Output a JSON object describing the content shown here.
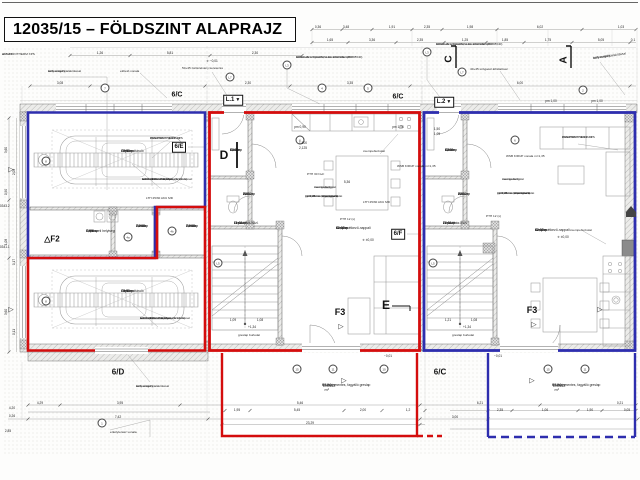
{
  "sheet": {
    "title": "12035/15 – FÖLDSZINT ALAPRAJZ"
  },
  "colors": {
    "unit_red": "#d40d0d",
    "unit_blue": "#2e2eae",
    "wall_hatch": "#b0b0b0",
    "dim_text": "#222222"
  },
  "rooms": [
    {
      "id": "G2.01",
      "name": "Gépkocsitároló",
      "area": "19,50 m²",
      "floor": "Greslap",
      "x": 121,
      "y": 149
    },
    {
      "id": "G1.01",
      "name": "Gépkocsitároló",
      "area": "19,50 m²",
      "floor": "Greslap",
      "x": 121,
      "y": 289
    },
    {
      "id": "G.03",
      "name": "Gépészeti helyiség",
      "area": "5,59 m²",
      "floor": "Greslap",
      "x": 86,
      "y": 229
    },
    {
      "id": "G2.02",
      "name": "Tároló",
      "area": "2,70 m²",
      "floor": "Greslap",
      "x": 136,
      "y": 224
    },
    {
      "id": "G1.02",
      "name": "Tároló",
      "area": "2,70 m²",
      "floor": "Greslap",
      "x": 186,
      "y": 224
    },
    {
      "id": "L1.01",
      "name": "Előtér",
      "area": "4,14 m²",
      "floor": "Greslap",
      "x": 230,
      "y": 148
    },
    {
      "id": "L1.02",
      "name": "WC",
      "area": "2,04 m²",
      "floor": "Greslap",
      "x": 243,
      "y": 192
    },
    {
      "id": "L1.04",
      "name": "Lépcsőház-közl.",
      "area": "11,02 m²",
      "floor": "Greslap",
      "x": 234,
      "y": 221
    },
    {
      "id": "L1.03",
      "name": "Konyha-étkező-nappali",
      "area": "42,00 m²",
      "floor": "Greslap",
      "x": 336,
      "y": 226
    },
    {
      "id": "L2.01",
      "name": "Előtér",
      "area": "4,14 m²",
      "floor": "Greslap",
      "x": 445,
      "y": 148
    },
    {
      "id": "L2.02",
      "name": "WC",
      "area": "2,04 m²",
      "floor": "Greslap",
      "x": 458,
      "y": 192
    },
    {
      "id": "L2.04",
      "name": "Lépcsőház-közl.",
      "area": "24,81 m²",
      "floor": "Greslap",
      "x": 443,
      "y": 221
    },
    {
      "id": "L2.03",
      "name": "Konyha-étkező-nappali",
      "area": "42,00 m²",
      "floor": "Greslap",
      "x": 535,
      "y": 228
    }
  ],
  "terraces": [
    {
      "name": "Terasz",
      "area": "17,50 m²",
      "note": "Csúszásmentes, fagyálló greslap",
      "x": 322,
      "y": 383
    },
    {
      "name": "Terasz",
      "area": "17,50 m²",
      "note": "Csúszásmentes, fagyálló greslap",
      "x": 552,
      "y": 383
    }
  ],
  "markers": {
    "boxed": [
      {
        "t": "L.1",
        "x": 233,
        "y": 100,
        "tri": true
      },
      {
        "t": "L.2",
        "x": 444,
        "y": 102,
        "tri": true
      },
      {
        "t": "6/E",
        "x": 179,
        "y": 147
      },
      {
        "t": "6/F",
        "x": 398,
        "y": 234
      }
    ],
    "plain": [
      {
        "t": "6/C",
        "x": 177,
        "y": 95,
        "s": 7
      },
      {
        "t": "6/C",
        "x": 398,
        "y": 97,
        "s": 7
      },
      {
        "t": "6/D",
        "x": 118,
        "y": 372,
        "s": 8
      },
      {
        "t": "6/C",
        "x": 440,
        "y": 372,
        "s": 8
      },
      {
        "t": "D",
        "x": 224,
        "y": 155,
        "s": 12
      },
      {
        "t": "E",
        "x": 386,
        "y": 305,
        "s": 12
      },
      {
        "t": "F3",
        "x": 340,
        "y": 312,
        "s": 9
      },
      {
        "t": "F3",
        "x": 532,
        "y": 310,
        "s": 9
      },
      {
        "t": "△F2",
        "x": 52,
        "y": 239,
        "s": 8
      }
    ],
    "rotated": [
      {
        "t": "C",
        "x": 449,
        "y": 59
      },
      {
        "t": "A",
        "x": 564,
        "y": 60
      }
    ],
    "triangles": [
      {
        "x": 341,
        "y": 327
      },
      {
        "x": 534,
        "y": 325
      },
      {
        "x": 344,
        "y": 381
      },
      {
        "x": 532,
        "y": 381
      },
      {
        "x": 600,
        "y": 310
      },
      {
        "x": 11,
        "y": 170
      },
      {
        "x": 11,
        "y": 310
      }
    ]
  },
  "bubbles": [
    {
      "x": 105,
      "y": 88,
      "t": "7"
    },
    {
      "x": 322,
      "y": 88,
      "t": "4"
    },
    {
      "x": 368,
      "y": 88,
      "t": "5"
    },
    {
      "x": 583,
      "y": 90,
      "t": "2"
    },
    {
      "x": 230,
      "y": 77,
      "t": "L7"
    },
    {
      "x": 462,
      "y": 72,
      "t": "L7"
    },
    {
      "x": 287,
      "y": 65,
      "t": "L3"
    },
    {
      "x": 427,
      "y": 52,
      "t": "L3"
    },
    {
      "x": 128,
      "y": 237,
      "t": "4a"
    },
    {
      "x": 172,
      "y": 231,
      "t": "4b"
    },
    {
      "x": 218,
      "y": 263,
      "t": "L5"
    },
    {
      "x": 433,
      "y": 263,
      "t": "L5"
    },
    {
      "x": 102,
      "y": 423,
      "t": "1"
    },
    {
      "x": 297,
      "y": 369,
      "t": "15"
    },
    {
      "x": 333,
      "y": 369,
      "t": "11"
    },
    {
      "x": 384,
      "y": 369,
      "t": "10"
    },
    {
      "x": 548,
      "y": 369,
      "t": "15"
    },
    {
      "x": 585,
      "y": 369,
      "t": "11"
    },
    {
      "x": 46,
      "y": 161,
      "t": "8"
    },
    {
      "x": 46,
      "y": 301,
      "t": "8"
    },
    {
      "x": 300,
      "y": 140,
      "t": "6"
    },
    {
      "x": 515,
      "y": 140,
      "t": "6"
    }
  ],
  "dims": [
    {
      "x": 318,
      "y": 27,
      "t": "0,36"
    },
    {
      "x": 346,
      "y": 27,
      "t": "3,48"
    },
    {
      "x": 392,
      "y": 27,
      "t": "1,91"
    },
    {
      "x": 427,
      "y": 27,
      "t": "2,35"
    },
    {
      "x": 470,
      "y": 27,
      "t": "1,98"
    },
    {
      "x": 540,
      "y": 27,
      "t": "6,02"
    },
    {
      "x": 621,
      "y": 27,
      "t": "1,03"
    },
    {
      "x": 330,
      "y": 40,
      "t": "1,65"
    },
    {
      "x": 372,
      "y": 40,
      "t": "3,36"
    },
    {
      "x": 420,
      "y": 40,
      "t": "2,35"
    },
    {
      "x": 465,
      "y": 40,
      "t": "1,25"
    },
    {
      "x": 505,
      "y": 40,
      "t": "1,85"
    },
    {
      "x": 548,
      "y": 40,
      "t": "1,75"
    },
    {
      "x": 601,
      "y": 40,
      "t": "5,05"
    },
    {
      "x": 633,
      "y": 40,
      "t": "0,1"
    },
    {
      "x": 100,
      "y": 53,
      "t": "1,26"
    },
    {
      "x": 170,
      "y": 53,
      "t": "5,81"
    },
    {
      "x": 255,
      "y": 53,
      "t": "2,30"
    },
    {
      "x": 60,
      "y": 83,
      "t": "3,08"
    },
    {
      "x": 248,
      "y": 83,
      "t": "2,30"
    },
    {
      "x": 350,
      "y": 83,
      "t": "3,35"
    },
    {
      "x": 520,
      "y": 83,
      "t": "6,00"
    },
    {
      "x": 6,
      "y": 150,
      "t": "3,60",
      "r": 1
    },
    {
      "x": 14,
      "y": 172,
      "t": "2,08",
      "r": 1
    },
    {
      "x": 6,
      "y": 192,
      "t": "0,90",
      "r": 1
    },
    {
      "x": 6,
      "y": 242,
      "t": "1,08",
      "r": 1
    },
    {
      "x": 14,
      "y": 262,
      "t": "0,17",
      "r": 1
    },
    {
      "x": 6,
      "y": 312,
      "t": "3,60",
      "r": 1
    },
    {
      "x": 14,
      "y": 332,
      "t": "0,11",
      "r": 1
    },
    {
      "x": 3,
      "y": 206,
      "t": "#10343.2"
    },
    {
      "x": 3,
      "y": 247,
      "t": "#10341.1"
    },
    {
      "x": 643,
      "y": 270,
      "t": "2,30",
      "r": 1
    },
    {
      "x": 650,
      "y": 310,
      "t": "1,35",
      "r": 1
    },
    {
      "x": 652,
      "y": 230,
      "t": "6,02",
      "r": 1
    },
    {
      "x": 40,
      "y": 403,
      "t": "4,29"
    },
    {
      "x": 120,
      "y": 403,
      "t": "3,95"
    },
    {
      "x": 300,
      "y": 403,
      "t": "5,46"
    },
    {
      "x": 480,
      "y": 403,
      "t": "6,21"
    },
    {
      "x": 620,
      "y": 403,
      "t": "0,21"
    },
    {
      "x": 237,
      "y": 410,
      "t": "1,95"
    },
    {
      "x": 297,
      "y": 410,
      "t": "5,45"
    },
    {
      "x": 363,
      "y": 410,
      "t": "2,00"
    },
    {
      "x": 408,
      "y": 410,
      "t": "1,2"
    },
    {
      "x": 500,
      "y": 410,
      "t": "2,35"
    },
    {
      "x": 545,
      "y": 410,
      "t": "1,06"
    },
    {
      "x": 590,
      "y": 410,
      "t": "1,90"
    },
    {
      "x": 627,
      "y": 410,
      "t": "0,05"
    },
    {
      "x": 118,
      "y": 417,
      "t": "7,42"
    },
    {
      "x": 455,
      "y": 417,
      "t": "3,00"
    },
    {
      "x": 310,
      "y": 423,
      "t": "23,29"
    },
    {
      "x": 12,
      "y": 408,
      "t": "4,20"
    },
    {
      "x": 12,
      "y": 416,
      "t": "0,26"
    },
    {
      "x": 8,
      "y": 431,
      "t": "2,85"
    },
    {
      "x": 233,
      "y": 320,
      "t": "1,09"
    },
    {
      "x": 260,
      "y": 320,
      "t": "1,08"
    },
    {
      "x": 448,
      "y": 320,
      "t": "1,21"
    },
    {
      "x": 474,
      "y": 320,
      "t": "1,08"
    },
    {
      "x": 252,
      "y": 327,
      "t": "+1,34"
    },
    {
      "x": 467,
      "y": 327,
      "t": "+1,34"
    },
    {
      "x": 368,
      "y": 240,
      "t": "✛ ±0,00"
    },
    {
      "x": 563,
      "y": 237,
      "t": "✛ ±0,00"
    },
    {
      "x": 212,
      "y": 61,
      "t": "✛ −0,01"
    },
    {
      "x": 388,
      "y": 356,
      "t": "−0,01"
    },
    {
      "x": 498,
      "y": 356,
      "t": "−0,01"
    },
    {
      "x": 300,
      "y": 127,
      "t": "pm 0,90"
    },
    {
      "x": 398,
      "y": 127,
      "t": "pm 1,06"
    },
    {
      "x": 551,
      "y": 101,
      "t": "pm 1,00"
    },
    {
      "x": 597,
      "y": 101,
      "t": "pm 1,00"
    },
    {
      "x": 347,
      "y": 182,
      "t": "5,36"
    },
    {
      "x": 303,
      "y": 143,
      "t": "1,500"
    },
    {
      "x": 303,
      "y": 148,
      "t": "2,125"
    },
    {
      "x": 437,
      "y": 129,
      "t": "1,50"
    },
    {
      "x": 437,
      "y": 134,
      "t": "1,05"
    }
  ],
  "notes": [
    {
      "x": 296,
      "y": 56,
      "lines": [
        "KROLLING SOLOMAL AL 1000 RE 120 HV",
        "kültéri alu árnyékoló, tokszerkezettel (RAL 7040)"
      ]
    },
    {
      "x": 436,
      "y": 43,
      "lines": [
        "KROLLING SOLOMAL AL 1000 RE 120 HV",
        "kültéri alu árnyékoló, tokszerkezettel (RAL 7040)"
      ]
    },
    {
      "x": 150,
      "y": 137,
      "lines": [
        "AUSZTROTHERM XPS",
        "PREMIUM P d=15 cm"
      ]
    },
    {
      "x": 562,
      "y": 136,
      "lines": [
        "AUSZTROTHERM XPS",
        "PREMIUM P d=15 cm"
      ]
    },
    {
      "x": 142,
      "y": 178,
      "lines": [
        "ACO HEXALINE folyóka",
        "korszerűsített kiépítése (l=1,0 m)",
        "autóbeállók vonalában, rácsfedéssel"
      ]
    },
    {
      "x": 140,
      "y": 317,
      "lines": [
        "ACO HEXALINE folyóka",
        "korszerűsített kiépítése (l=1,0 m)",
        "autóbeállók vonalában, rácsfedéssel"
      ]
    },
    {
      "x": 146,
      "y": 197,
      "lines": [
        "LTH 25/30 AKU MD"
      ]
    },
    {
      "x": 363,
      "y": 201,
      "lines": [
        "LTH 25/30 AKU MD"
      ]
    },
    {
      "x": 506,
      "y": 155,
      "lines": [
        "WSB KIRUP vonala m=1,35"
      ]
    },
    {
      "x": 397,
      "y": 165,
      "lines": [
        "WSB KIRUP vonala m=1,35"
      ]
    },
    {
      "x": 314,
      "y": 186,
      "lines": [
        "csempeburkolat",
        "mennyezetig"
      ]
    },
    {
      "x": 502,
      "y": 178,
      "lines": [
        "csempeburkolat",
        "mennyezetig"
      ]
    },
    {
      "x": 305,
      "y": 195,
      "lines": [
        "m=0,40 cm lábazatburkolat",
        "gipszkarton előtétfalazat",
        "m=1,25 cm (impregnált)"
      ]
    },
    {
      "x": 497,
      "y": 192,
      "lines": [
        "m=0,40 cm lábazatburkolat",
        "gipszkarton előtétfalazat",
        "m=1,25 cm (impregnált)"
      ]
    },
    {
      "x": 363,
      "y": 150,
      "lines": [
        "csempeburkolat"
      ]
    },
    {
      "x": 570,
      "y": 229,
      "lines": [
        "csempeburkolat"
      ]
    },
    {
      "x": 48,
      "y": 70,
      "lines": [
        "kerti szegély,",
        "süllyesztett kialakítással"
      ]
    },
    {
      "x": 593,
      "y": 57,
      "lines": [
        "kerti szegély,",
        "süllyesztett kialakítással"
      ],
      "rot": -8
    },
    {
      "x": 136,
      "y": 385,
      "lines": [
        "kerti szegély,",
        "süllyesztett kialakítással"
      ]
    },
    {
      "x": 120,
      "y": 70,
      "lines": [
        "előtető vonala"
      ]
    },
    {
      "x": 182,
      "y": 67,
      "lines": [
        "50+45 zártszelvény keretezés"
      ]
    },
    {
      "x": 470,
      "y": 68,
      "lines": [
        "40+45 szögacél áthidalóval"
      ]
    },
    {
      "x": 307,
      "y": 173,
      "lines": [
        "PTH 30 N+F"
      ]
    },
    {
      "x": 340,
      "y": 218,
      "lines": [
        "PTH 12 (s)"
      ]
    },
    {
      "x": 486,
      "y": 215,
      "lines": [
        "PTH 12 (s)"
      ]
    },
    {
      "x": 238,
      "y": 334,
      "lines": [
        "greslap burkolat"
      ]
    },
    {
      "x": 452,
      "y": 334,
      "lines": [
        "greslap burkolat"
      ]
    },
    {
      "x": 110,
      "y": 431,
      "lines": [
        "erkélyterasz vonala"
      ]
    },
    {
      "x": 2,
      "y": 53,
      "lines": [
        "AUSZTROTHERM XPS",
        "d=7 cm"
      ]
    }
  ]
}
